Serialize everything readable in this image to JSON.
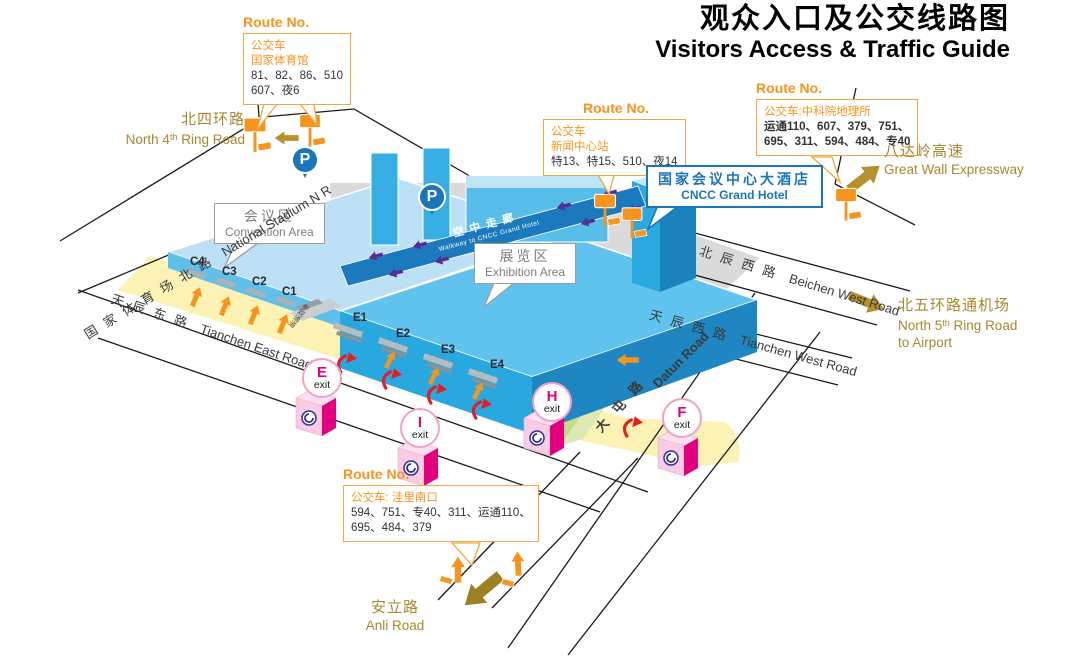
{
  "title": {
    "zh": "观众入口及公交线路图",
    "en": "Visitors Access & Traffic Guide"
  },
  "route_boxes": {
    "stadium": {
      "title": "Route No.",
      "line1": "公交车",
      "line2": "国家体育馆",
      "nums1": "81、82、86、510",
      "nums2": "607、夜6"
    },
    "press": {
      "title": "Route No.",
      "line1": "公交车",
      "line2": "新闻中心站",
      "nums1": "特13、特15、510、夜14"
    },
    "cas": {
      "title": "Route No.",
      "line1": "公交车:中科院地理所",
      "nums1": "运通110、607、379、751、",
      "nums2": "695、311、594、484、专40"
    },
    "wali": {
      "title": "Route No.",
      "line1": "公交车: 洼里南口",
      "nums1": "594、751、专40、311、运通110、",
      "nums2": "695、484、379"
    }
  },
  "areas": {
    "convention": {
      "zh": "会议区",
      "en": "Convention Area"
    },
    "exhibition": {
      "zh": "展览区",
      "en": "Exhibition Area"
    },
    "hotel": {
      "zh": "国家会议中心大酒店",
      "en": "CNCC Grand Hotel"
    }
  },
  "roads": {
    "north4th": {
      "zh": "北四环路",
      "en_pre": "North 4",
      "en_sup": "th",
      "en_post": " Ring Road"
    },
    "natstadium": {
      "zh": "国家体育场北路",
      "en": "National Stadium N R"
    },
    "tianchen_east": {
      "zh": "天辰东路",
      "en": "Tianchen East Road"
    },
    "beichen_west": {
      "zh": "北辰西路",
      "en": "Beichen West Road"
    },
    "tianchen_west": {
      "zh": "天辰西路",
      "en": "Tianchen West Road"
    },
    "datun": {
      "zh": "大屯路",
      "en": "Datun Road"
    },
    "expressway": {
      "zh": "八达岭高速",
      "en": "Great Wall Expressway"
    },
    "north5th": {
      "zh": "北五环路通机场",
      "en_pre": "North 5",
      "en_sup": "th",
      "en_post": " Ring Road",
      "en2": "to Airport"
    },
    "anli": {
      "zh": "安立路",
      "en": "Anli Road"
    }
  },
  "entrances": {
    "c4": "C4",
    "c3": "C3",
    "c2": "C2",
    "c1": "C1",
    "e1": "E1",
    "e2": "E2",
    "e3": "E3",
    "e4": "E4"
  },
  "exits": {
    "e": {
      "letter": "E",
      "word": "exit"
    },
    "i": {
      "letter": "I",
      "word": "exit"
    },
    "h": {
      "letter": "H",
      "word": "exit"
    },
    "f": {
      "letter": "F",
      "word": "exit"
    }
  },
  "walkway": {
    "zh": "空中走廊",
    "en": "Walkway to CNCC Grand Hotel"
  },
  "parking_label": "P",
  "ramp_label": "参观通道",
  "colors": {
    "orange": "#F7941D",
    "gold": "#A8872E",
    "building_blue": "#2AA9E1",
    "dark_blue": "#1B75BB",
    "metro_pink": "#E5007D",
    "red": "#E31E24",
    "purple": "#5B2D90",
    "plaza_yellow": "#FBF2B4",
    "green": "#C3DB90",
    "road_grey": "#DADADA"
  }
}
